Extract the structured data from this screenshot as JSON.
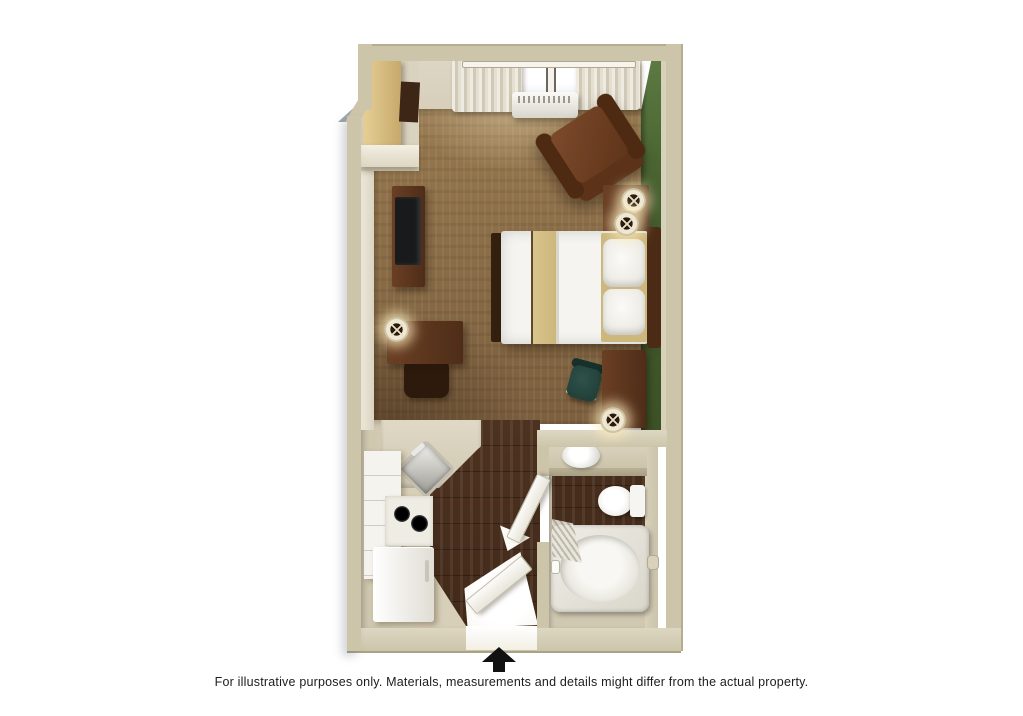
{
  "meta": {
    "type": "3d-floor-plan",
    "unit": "studio suite"
  },
  "caption": {
    "text": "For illustrative purposes only.  Materials, measurements and details might differ from the actual property."
  },
  "north_arrow": {
    "direction": "up"
  },
  "palette": {
    "wall": "#cdc5aa",
    "wall_light": "#ddd6c2",
    "wall_shadow": "#b5ad90",
    "inner_wall": "#d7cfba",
    "accent_wall_green": "#46602f",
    "accent_wall_green_light": "#5c7a42",
    "carpet": "#8d6f47",
    "wood_floor": "#462c1b",
    "furniture_dark": "#4e2d18",
    "furniture_mid": "#6b3f24",
    "bedding_white": "#f5f4f0",
    "tan_fabric": "#ccb77c",
    "fixture_white": "#f3f2ec",
    "kitchen_floor": "#d8cfb9",
    "counter": "#e0d9c6",
    "arrow_black": "#111111",
    "text": "#1c1c1c"
  },
  "rooms": [
    {
      "name": "living-sleeping-area",
      "floor": "carpet",
      "features": [
        "window-with-curtains",
        "wall-air-conditioner",
        "recliner-armchair",
        "nightstand-two-lamps",
        "bed-with-runner",
        "tv-console",
        "closet-shelving",
        "desk-with-chair-and-lamp",
        "desk-with-office-chair",
        "floor-lamp",
        "green-accent-wall"
      ]
    },
    {
      "name": "kitchen",
      "floor": "dark-wood-and-vinyl",
      "features": [
        "corner-sink",
        "two-burner-cooktop",
        "refrigerator",
        "cabinet-tower",
        "counter",
        "entry-door"
      ]
    },
    {
      "name": "bathroom",
      "floor": "dark-wood",
      "features": [
        "vanity-with-sink",
        "toilet",
        "bathtub",
        "shower-curtain",
        "grab-bar",
        "door"
      ]
    }
  ]
}
